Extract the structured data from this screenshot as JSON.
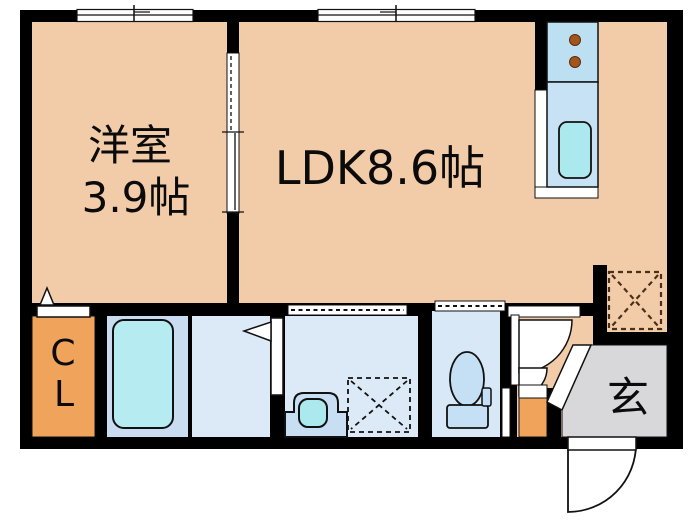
{
  "plan": {
    "rooms": {
      "western": {
        "name": "洋室",
        "size": "3.9帖"
      },
      "ldk": {
        "label": "LDK8.6帖"
      },
      "closet": {
        "letter1": "C",
        "letter2": "L"
      },
      "entrance": {
        "label": "玄"
      }
    },
    "colors": {
      "wall": "#000000",
      "floor_tatami": "#F2CBA9",
      "closet_orange": "#EFA35B",
      "shoebox_orange": "#EFA35B",
      "entrance_gray": "#D8D8DA",
      "bathroom_floor": "#C9DCF1",
      "dressing_floor": "#DCEAF8",
      "washroom_floor": "#DCEAF8",
      "toilet_floor": "#D9E8F7",
      "bathtub_fill": "#B5EBF1",
      "sink_cyan": "#ABE9EF",
      "basin_fill": "#C8DFF3",
      "kitchen_stove": "#BCDFF2",
      "kitchen_counter": "#C6E2F4",
      "toilet_fixture": "#C5DFF4",
      "burner_brown": "#A2551D",
      "fridge_dash": "#4A3018"
    }
  }
}
